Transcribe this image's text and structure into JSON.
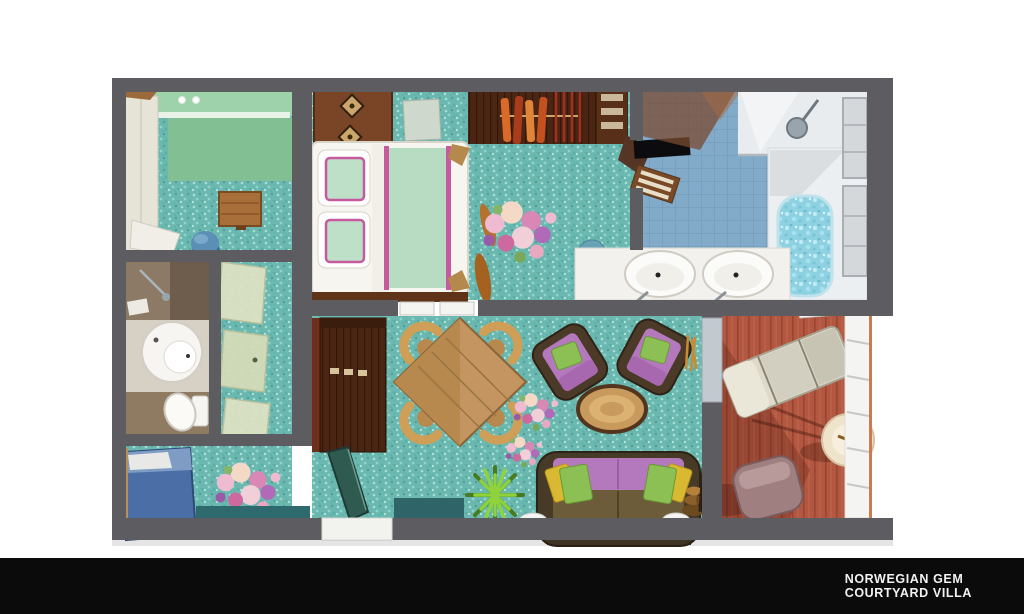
{
  "footer": {
    "line1": "NORWEGIAN GEM",
    "line2": "COURTYARD VILLA"
  },
  "palette": {
    "background": "#ffffff",
    "footer_bg": "#0b0b0b",
    "footer_text": "#f2f2f2",
    "wall": "#5d5d61",
    "carpet": "#6ab8b0",
    "mint_wall": "#8fc89e",
    "tile_blue": "#82abc9",
    "water": "#8ed2e2",
    "deck": "#b25741",
    "wood_light": "#c59a62",
    "wood_dark": "#4a2513",
    "bed_blanket": "#b7dcc2",
    "bed_trim": "#c75a9e",
    "sofa_frame": "#473a27",
    "cushion_purple": "#b478bc",
    "pillow_green": "#8cbf54",
    "pillow_yellow": "#d9b832",
    "daybed_blue": "#4a6ea5",
    "plant_green": "#8ed23e",
    "glass_green": "#dfe2c4",
    "fixture_white": "#f2f1ed",
    "lounger_cream": "#ded9c8",
    "balcony_chair": "#9f7f80",
    "railing_white": "#f4f4f2"
  }
}
